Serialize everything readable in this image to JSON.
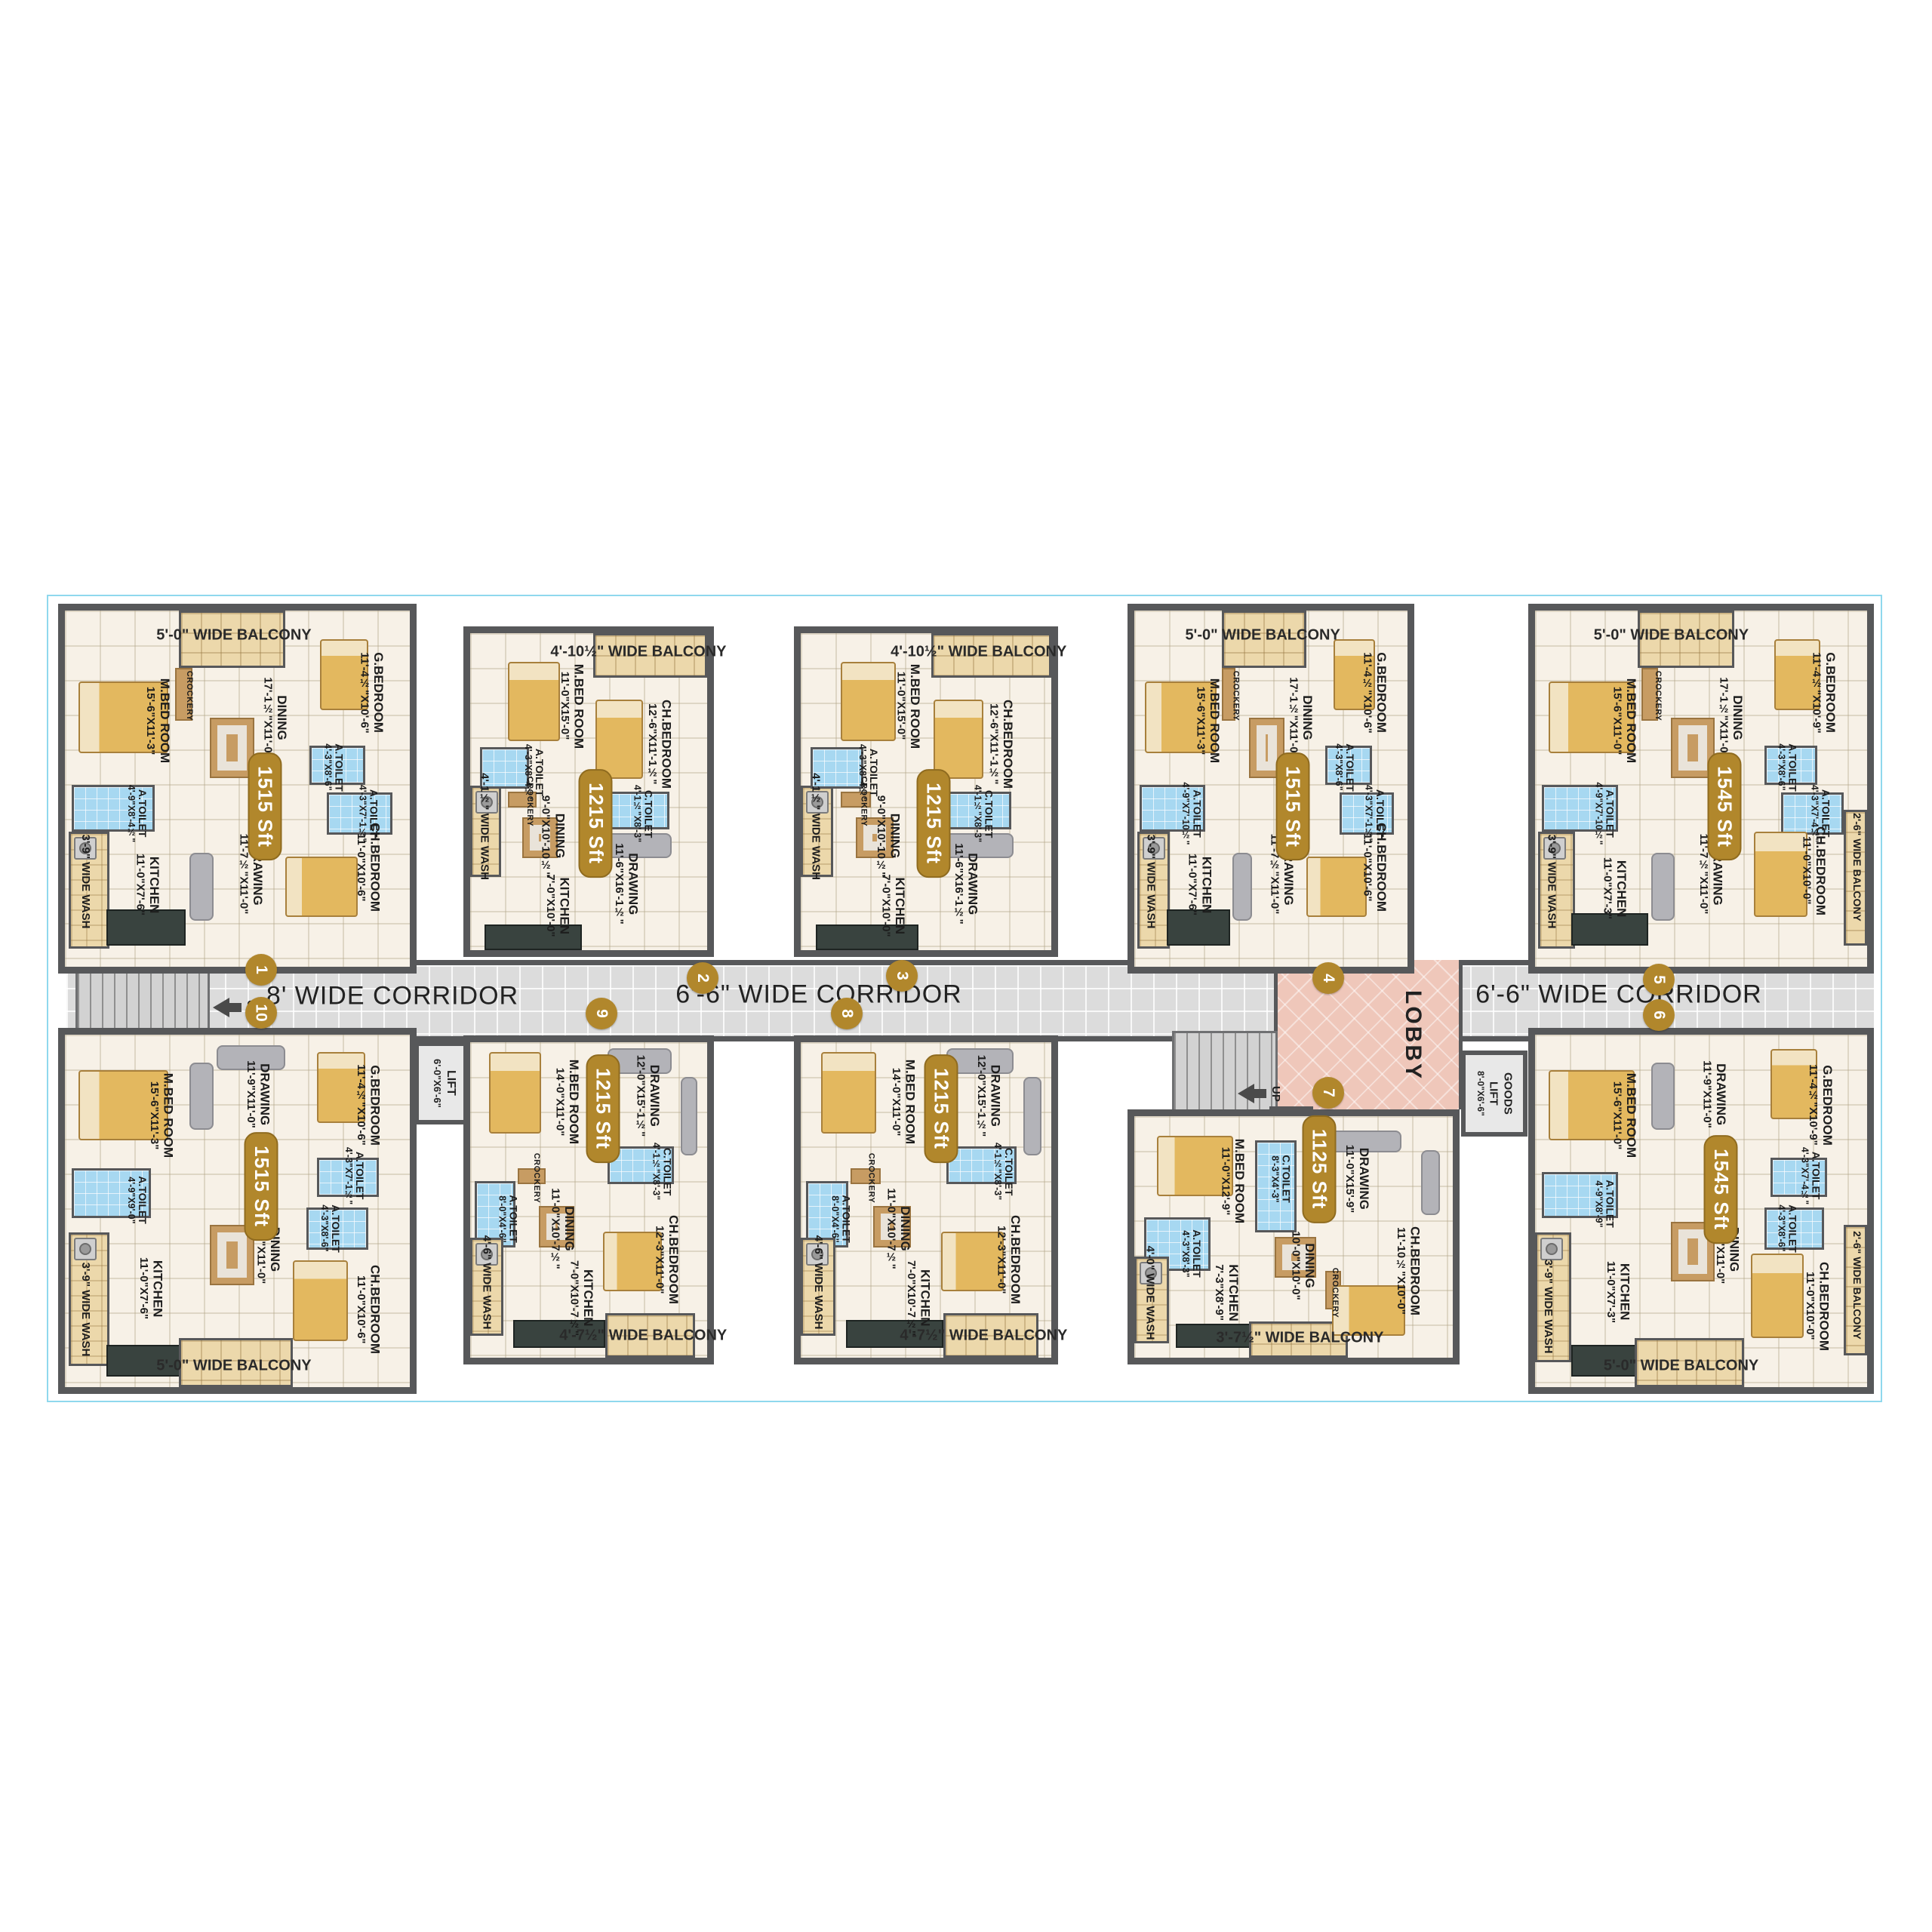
{
  "corridors": {
    "left": "8' WIDE CORRIDOR",
    "middle": "6'-6\" WIDE CORRIDOR",
    "right": "6'-6\" WIDE CORRIDOR"
  },
  "lobby_label": "LOBBY",
  "up_label": "UP",
  "lift": {
    "name": "LIFT",
    "dims": "6'-0\"X6'-6\""
  },
  "goods_lift": {
    "name1": "GOODS",
    "name2": "LIFT",
    "dims": "8'-0\"X6'-6\""
  },
  "units": [
    {
      "number": "1",
      "area": "1515 Sft",
      "labels": [
        {
          "kind": "balcony",
          "name": "5'-0\" WIDE BALCONY"
        },
        {
          "kind": "room",
          "name": "M.BED ROOM",
          "dims": "15'-6\"X11'-3\""
        },
        {
          "kind": "crockery",
          "name": "CROCKERY"
        },
        {
          "kind": "room",
          "name": "DINING",
          "dims": "17'-1½\"X11'-0\""
        },
        {
          "kind": "room",
          "name": "G.BEDROOM",
          "dims": "11'-4½\"X10'-6\""
        },
        {
          "kind": "toilet",
          "name": "A.TOILET",
          "dims": "4'-3\"X8'-6\""
        },
        {
          "kind": "toilet",
          "name": "A.TOILET",
          "dims": "4'-3\"X7'-1½\""
        },
        {
          "kind": "toilet",
          "name": "A.TOILET",
          "dims": "4'-9\"X8'-4½\""
        },
        {
          "kind": "room",
          "name": "KITCHEN",
          "dims": "11'-0\"X7'-6\""
        },
        {
          "kind": "room",
          "name": "DRAWING",
          "dims": "11'-7½\"X11'-0\""
        },
        {
          "kind": "room",
          "name": "CH.BEDROOM",
          "dims": "11'-0\"X10'-6\""
        },
        {
          "kind": "wash",
          "name": "3'-9\" WIDE WASH"
        }
      ]
    },
    {
      "number": "2",
      "area": "1215 Sft",
      "labels": [
        {
          "kind": "balcony",
          "name": "4'-10½\" WIDE BALCONY"
        },
        {
          "kind": "room",
          "name": "M.BED ROOM",
          "dims": "11'-0\"X15'-0\""
        },
        {
          "kind": "room",
          "name": "CH.BEDROOM",
          "dims": "12'-6\"X11'-1½\""
        },
        {
          "kind": "toilet",
          "name": "A.TOILET",
          "dims": "4'-3\"X8'-4½\""
        },
        {
          "kind": "toilet",
          "name": "C.TOILET",
          "dims": "4'-1½\"X8'-3\""
        },
        {
          "kind": "crockery",
          "name": "CROCKERY"
        },
        {
          "kind": "wash",
          "name": "4'-1½\" WIDE WASH"
        },
        {
          "kind": "room",
          "name": "DINING",
          "dims": "9'-0\"X10'-10½\""
        },
        {
          "kind": "room",
          "name": "KITCHEN",
          "dims": "7'-0\"X10'-0\""
        },
        {
          "kind": "room",
          "name": "DRAWING",
          "dims": "11'-6\"X16'-1½\""
        }
      ]
    },
    {
      "number": "3",
      "area": "1215 Sft",
      "labels": [
        {
          "kind": "balcony",
          "name": "4'-10½\" WIDE BALCONY"
        },
        {
          "kind": "room",
          "name": "M.BED ROOM",
          "dims": "11'-0\"X15'-0\""
        },
        {
          "kind": "room",
          "name": "CH.BEDROOM",
          "dims": "12'-6\"X11'-1½\""
        },
        {
          "kind": "toilet",
          "name": "A.TOILET",
          "dims": "4'-3\"X8'-4½\""
        },
        {
          "kind": "toilet",
          "name": "C.TOILET",
          "dims": "4'-1½\"X8'-3\""
        },
        {
          "kind": "crockery",
          "name": "CROCKERY"
        },
        {
          "kind": "wash",
          "name": "4'-1½\" WIDE WASH"
        },
        {
          "kind": "room",
          "name": "DINING",
          "dims": "9'-0\"X10'-10½\""
        },
        {
          "kind": "room",
          "name": "KITCHEN",
          "dims": "7'-0\"X10'-0\""
        },
        {
          "kind": "room",
          "name": "DRAWING",
          "dims": "11'-6\"X16'-1½\""
        }
      ]
    },
    {
      "number": "4",
      "area": "1515 Sft",
      "labels": [
        {
          "kind": "balcony",
          "name": "5'-0\" WIDE BALCONY"
        },
        {
          "kind": "room",
          "name": "M.BED ROOM",
          "dims": "15'-6\"X11'-3\""
        },
        {
          "kind": "crockery",
          "name": "CROCKERY"
        },
        {
          "kind": "room",
          "name": "DINING",
          "dims": "17'-1½\"X11'-0\""
        },
        {
          "kind": "room",
          "name": "G.BEDROOM",
          "dims": "11'-4½\"X10'-6\""
        },
        {
          "kind": "toilet",
          "name": "A.TOILET",
          "dims": "4'-3\"X8'-6\""
        },
        {
          "kind": "toilet",
          "name": "A.TOILET",
          "dims": "4'-3\"X7'-1½\""
        },
        {
          "kind": "toilet",
          "name": "A.TOILET",
          "dims": "4'-9\"X7'-10½\""
        },
        {
          "kind": "room",
          "name": "KITCHEN",
          "dims": "11'-0\"X7'-6\""
        },
        {
          "kind": "room",
          "name": "DRAWING",
          "dims": "11'-7½\"X11'-0\""
        },
        {
          "kind": "room",
          "name": "CH.BEDROOM",
          "dims": "11'-0\"X10'-6\""
        },
        {
          "kind": "wash",
          "name": "3'-9\" WIDE WASH"
        }
      ]
    },
    {
      "number": "5",
      "area": "1545 Sft",
      "labels": [
        {
          "kind": "balcony",
          "name": "5'-0\" WIDE BALCONY"
        },
        {
          "kind": "room",
          "name": "M.BED ROOM",
          "dims": "15'-6\"X11'-0\""
        },
        {
          "kind": "crockery",
          "name": "CROCKERY"
        },
        {
          "kind": "room",
          "name": "DINING",
          "dims": "17'-1½\"X11'-0\""
        },
        {
          "kind": "room",
          "name": "G.BEDROOM",
          "dims": "11'-4½\"X10'-9\""
        },
        {
          "kind": "toilet",
          "name": "A.TOILET",
          "dims": "4'-3\"X8'-6\""
        },
        {
          "kind": "toilet",
          "name": "A.TOILET",
          "dims": "4'-3\"X7'-4½\""
        },
        {
          "kind": "toilet",
          "name": "A.TOILET",
          "dims": "4'-9\"X7'-10½\""
        },
        {
          "kind": "room",
          "name": "KITCHEN",
          "dims": "11'-0\"X7'-3\""
        },
        {
          "kind": "room",
          "name": "DRAWING",
          "dims": "11'-7½\"X11'-0\""
        },
        {
          "kind": "room",
          "name": "CH.BEDROOM",
          "dims": "11'-0\"X10'-0\""
        },
        {
          "kind": "wash",
          "name": "3'-9\" WIDE WASH"
        },
        {
          "kind": "balcony_v",
          "name": "2'-6\" WIDE BALCONY"
        }
      ]
    },
    {
      "number": "6",
      "area": "1545 Sft",
      "labels": [
        {
          "kind": "room",
          "name": "M.BED ROOM",
          "dims": "15'-6\"X11'-0\""
        },
        {
          "kind": "room",
          "name": "DRAWING",
          "dims": "11'-9\"X11'-0\""
        },
        {
          "kind": "room",
          "name": "G.BEDROOM",
          "dims": "11'-4½\"X10'-9\""
        },
        {
          "kind": "toilet",
          "name": "A.TOILET",
          "dims": "4'-3\"X7'-4½\""
        },
        {
          "kind": "toilet",
          "name": "A.TOILET",
          "dims": "4'-3\"X8'-6\""
        },
        {
          "kind": "toilet",
          "name": "A.TOILET",
          "dims": "4'-9\"X8'-9\""
        },
        {
          "kind": "room",
          "name": "DINING",
          "dims": "17'-0\"X11'-0\""
        },
        {
          "kind": "room",
          "name": "KITCHEN",
          "dims": "11'-0\"X7'-3\""
        },
        {
          "kind": "room",
          "name": "CH.BEDROOM",
          "dims": "11'-0\"X10'-0\""
        },
        {
          "kind": "balcony_v",
          "name": "2'-6\" WIDE BALCONY"
        },
        {
          "kind": "wash",
          "name": "3'-9\" WIDE WASH"
        },
        {
          "kind": "balcony",
          "name": "5'-0\" WIDE BALCONY"
        }
      ]
    },
    {
      "number": "7",
      "area": "1125 Sft",
      "labels": [
        {
          "kind": "room",
          "name": "M.BED ROOM",
          "dims": "11'-0\"X12'-9\""
        },
        {
          "kind": "toilet",
          "name": "C.TOILET",
          "dims": "8'-3\"X4'-3\""
        },
        {
          "kind": "room",
          "name": "DRAWING",
          "dims": "11'-0\"X15'-9\""
        },
        {
          "kind": "toilet",
          "name": "A.TOILET",
          "dims": "4'-3\"X8'-3\""
        },
        {
          "kind": "room",
          "name": "KITCHEN",
          "dims": "7'-3\"X8'-9\""
        },
        {
          "kind": "room",
          "name": "DINING",
          "dims": "10'-0\"X10'-0\""
        },
        {
          "kind": "crockery",
          "name": "CROCKERY"
        },
        {
          "kind": "room",
          "name": "CH.BEDROOM",
          "dims": "11'-10½\"X10'-0\""
        },
        {
          "kind": "wash",
          "name": "4'-0\" WIDE WASH"
        },
        {
          "kind": "balcony",
          "name": "3'-7½\" WIDE BALCONY"
        }
      ]
    },
    {
      "number": "8",
      "area": "1215 Sft",
      "labels": [
        {
          "kind": "room",
          "name": "M.BED ROOM",
          "dims": "14'-0\"X11'-0\""
        },
        {
          "kind": "room",
          "name": "DRAWING",
          "dims": "12'-0\"X15'-1½\""
        },
        {
          "kind": "toilet",
          "name": "C.TOILET",
          "dims": "4'-1½\"X8'-3\""
        },
        {
          "kind": "toilet",
          "name": "A.TOILET",
          "dims": "8'-0\"X4'-6\""
        },
        {
          "kind": "crockery",
          "name": "CROCKERY"
        },
        {
          "kind": "room",
          "name": "DINING",
          "dims": "11'-0\"X10'-7½\""
        },
        {
          "kind": "room",
          "name": "KITCHEN",
          "dims": "7'-0\"X10'-7½\""
        },
        {
          "kind": "room",
          "name": "CH.BEDROOM",
          "dims": "12'-3\"X11'-0\""
        },
        {
          "kind": "wash",
          "name": "4'-6\" WIDE WASH"
        },
        {
          "kind": "balcony",
          "name": "4'-7½\" WIDE BALCONY"
        }
      ]
    },
    {
      "number": "9",
      "area": "1215 Sft",
      "labels": [
        {
          "kind": "room",
          "name": "M.BED ROOM",
          "dims": "14'-0\"X11'-0\""
        },
        {
          "kind": "room",
          "name": "DRAWING",
          "dims": "12'-0\"X15'-1½\""
        },
        {
          "kind": "toilet",
          "name": "C.TOILET",
          "dims": "4'-1½\"X8'-3\""
        },
        {
          "kind": "toilet",
          "name": "A.TOILET",
          "dims": "8'-0\"X4'-6\""
        },
        {
          "kind": "crockery",
          "name": "CROCKERY"
        },
        {
          "kind": "room",
          "name": "DINING",
          "dims": "11'-0\"X10'-7½\""
        },
        {
          "kind": "room",
          "name": "KITCHEN",
          "dims": "7'-0\"X10'-7½\""
        },
        {
          "kind": "room",
          "name": "CH.BEDROOM",
          "dims": "12'-3\"X11'-0\""
        },
        {
          "kind": "wash",
          "name": "4'-6\" WIDE WASH"
        },
        {
          "kind": "balcony",
          "name": "4'-7½\" WIDE BALCONY"
        }
      ]
    },
    {
      "number": "10",
      "area": "1515 Sft",
      "labels": [
        {
          "kind": "room",
          "name": "M.BED ROOM",
          "dims": "15'-6\"X11'-3\""
        },
        {
          "kind": "room",
          "name": "DRAWING",
          "dims": "11'-9\"X11'-0\""
        },
        {
          "kind": "room",
          "name": "G.BEDROOM",
          "dims": "11'-4½\"X10'-6\""
        },
        {
          "kind": "toilet",
          "name": "A.TOILET",
          "dims": "4'-3\"X7'-1½\""
        },
        {
          "kind": "toilet",
          "name": "A.TOILET",
          "dims": "4'-3\"X8'-6\""
        },
        {
          "kind": "toilet",
          "name": "A.TOILET",
          "dims": "4'-9\"X9'-0\""
        },
        {
          "kind": "room",
          "name": "DINING",
          "dims": "17'-0\"X11'-0\""
        },
        {
          "kind": "room",
          "name": "KITCHEN",
          "dims": "11'-0\"X7'-6\""
        },
        {
          "kind": "room",
          "name": "CH.BEDROOM",
          "dims": "11'-0\"X10'-6\""
        },
        {
          "kind": "wash",
          "name": "3'-9\" WIDE WASH"
        },
        {
          "kind": "balcony",
          "name": "5'-0\" WIDE BALCONY"
        }
      ]
    }
  ]
}
